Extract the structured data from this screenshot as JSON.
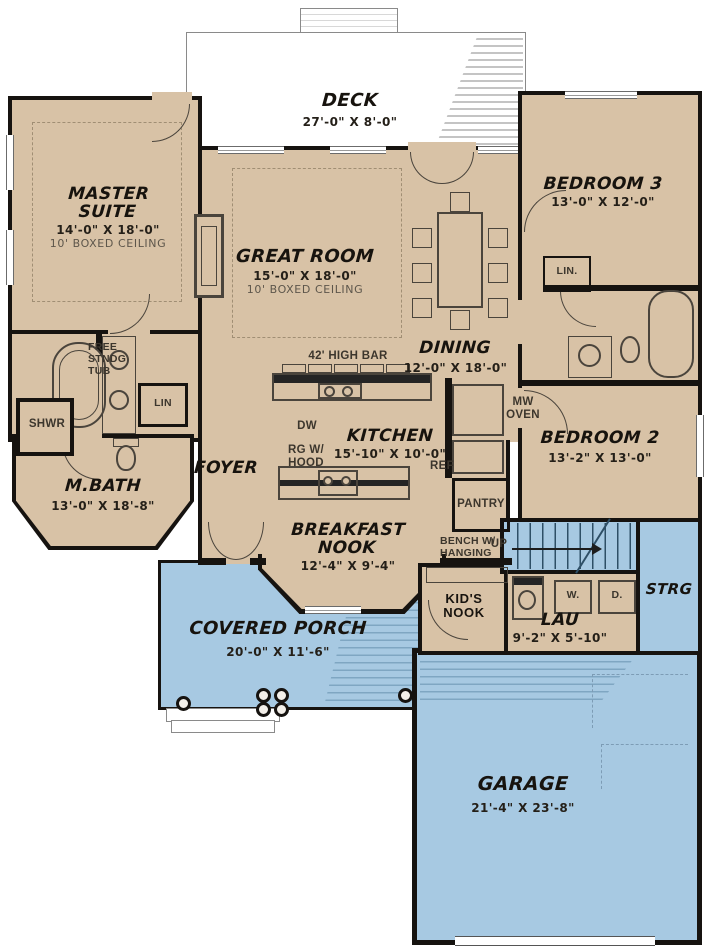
{
  "colors": {
    "interior": "#d8c2a6",
    "outdoor": "#a7c9e2",
    "wall": "#161310",
    "paper": "#ffffff"
  },
  "rooms": {
    "deck": {
      "name": "DECK",
      "dims": "27'-0\" X 8'-0\""
    },
    "master": {
      "name": "MASTER SUITE",
      "dims": "14'-0\" X 18'-0\"",
      "note": "10' BOXED CEILING"
    },
    "great": {
      "name": "GREAT ROOM",
      "dims": "15'-0\" X 18'-0\"",
      "note": "10' BOXED CEILING"
    },
    "bedroom3": {
      "name": "BEDROOM 3",
      "dims": "13'-0\" X 12'-0\""
    },
    "dining": {
      "name": "DINING",
      "dims": "12'-0\" X 18'-0\""
    },
    "kitchen": {
      "name": "KITCHEN",
      "dims": "15'-10\" X 10'-0\""
    },
    "bedroom2": {
      "name": "BEDROOM 2",
      "dims": "13'-2\" X 13'-0\""
    },
    "mbath": {
      "name": "M.BATH",
      "dims": "13'-0\" X 18'-8\""
    },
    "foyer": {
      "name": "FOYER"
    },
    "nook": {
      "name": "BREAKFAST NOOK",
      "dims": "12'-4\" X 9'-4\""
    },
    "kids_nook": {
      "name": "KID'S NOOK"
    },
    "laundry": {
      "name": "LAU",
      "dims": "9'-2\" X 5'-10\""
    },
    "porch": {
      "name": "COVERED PORCH",
      "dims": "20'-0\" X 11'-6\""
    },
    "garage": {
      "name": "GARAGE",
      "dims": "21'-4\" X 23'-8\""
    },
    "storage": {
      "name": "STRG"
    }
  },
  "fixtures": {
    "high_bar": "42' HIGH BAR",
    "dw": "DW",
    "mw_oven": "MW OVEN",
    "rg_hood": "RG W/ HOOD",
    "ref": "REF",
    "pantry": "PANTRY",
    "free_tub": "FREE STNDG TUB",
    "shower": "SHWR",
    "linen_master": "LIN",
    "linen_hall": "LIN.",
    "bench": "BENCH W/ HANGING",
    "up": "UP",
    "washer": "W.",
    "dryer": "D."
  }
}
